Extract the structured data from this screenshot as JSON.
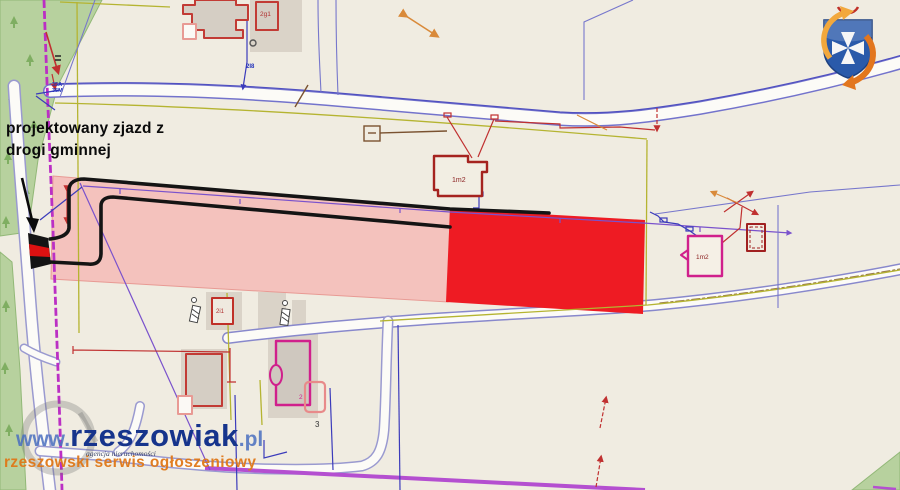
{
  "annotation": {
    "line1": "projektowany zjazd z",
    "line2": "drogi gminnej"
  },
  "watermark": {
    "www": "www.",
    "brand": "rzeszowiak",
    "tld": ".pl",
    "agency": "agencja nieruchomości",
    "subtitle": "rzeszowski serwis ogłoszeniowy"
  },
  "map_labels": {
    "building_top": "2g1",
    "building_center": "1m2",
    "building_right": "1m2",
    "building_small": "2i1",
    "building_bottom": "2",
    "garage": "3",
    "utility": "2I8",
    "boundary_a": "35A",
    "boundary_b": "35M"
  },
  "colors": {
    "background": "#f0ece1",
    "parcel_red": "#ee1b23",
    "parcel_pink": "#f4c2bd",
    "forest_green": "#b7d19e",
    "road_white": "#fcfbf7",
    "road_edge_blue": "#7373cc",
    "boundary_magenta": "#bb2fc4",
    "utility_violet": "#7a52cc",
    "utility_olive": "#b5b431",
    "utility_red": "#c03030",
    "utility_navy": "#3b3bbb",
    "building_outline_red": "#c23b35",
    "building_outline_magenta": "#d0208c",
    "brand_navy": "#16348c",
    "brand_blue": "#4a6fc0",
    "brand_orange": "#e07818"
  }
}
